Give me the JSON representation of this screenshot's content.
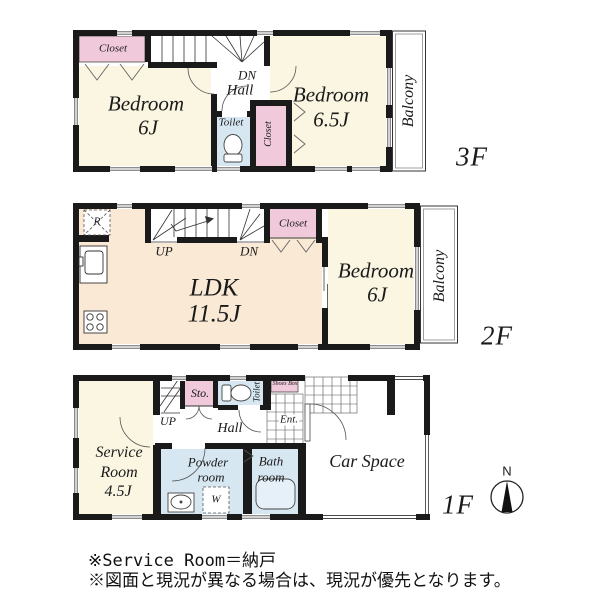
{
  "floor3": {
    "label": "3F",
    "closet_left": "Closet",
    "stair_dn": "DN",
    "hall": "Hall",
    "toilet": "Toilet",
    "closet_right": "Closet",
    "bedroom_left": {
      "name": "Bedroom",
      "size": "6J"
    },
    "bedroom_right": {
      "name": "Bedroom",
      "size": "6.5J"
    },
    "balcony": "Balcony"
  },
  "floor2": {
    "label": "2F",
    "refrigerator": "R",
    "stair_up": "UP",
    "stair_dn": "DN",
    "closet": "Closet",
    "ldk": {
      "name": "LDK",
      "size": "11.5J"
    },
    "bedroom": {
      "name": "Bedroom",
      "size": "6J"
    },
    "balcony": "Balcony"
  },
  "floor1": {
    "label": "1F",
    "stair_up": "UP",
    "storage": "Sto.",
    "toilet": "Toilet",
    "shoes_box": "Shoes Box",
    "entrance": "Ent.",
    "hall": "Hall",
    "service_room": {
      "line1": "Service",
      "line2": "Room",
      "line3": "4.5J"
    },
    "powder_room": {
      "line1": "Powder",
      "line2": "room"
    },
    "bath_room": {
      "line1": "Bath",
      "line2": "room"
    },
    "washer": "W",
    "car_space": "Car Space"
  },
  "compass": {
    "north": "N"
  },
  "notes": {
    "line1": "※Service Room＝納戸",
    "line2": "※図面と現況が異なる場合は、現況が優先となります。"
  },
  "icons": {
    "toilet": "toilet-icon",
    "sink": "sink-icon",
    "bathtub": "bathtub-icon",
    "stove": "stove-icon",
    "refrigerator": "refrigerator-box",
    "washer": "washer-box",
    "compass": "compass-icon"
  },
  "colors": {
    "room_cream": "#faf6e2",
    "room_peach": "#f9e9d5",
    "closet_pink": "#f0c9da",
    "wet_blue": "#d7e7f2",
    "wall": "#1a1a1a"
  }
}
